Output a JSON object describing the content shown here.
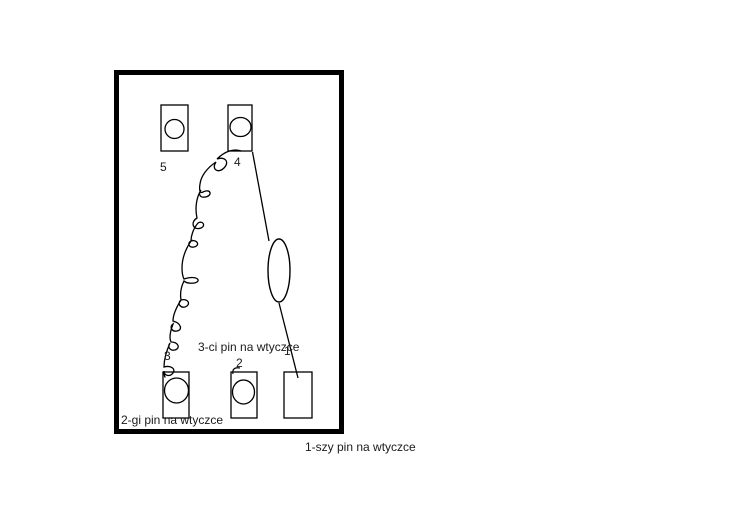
{
  "page": {
    "background_color": "#ffffff",
    "ink_color": "#000000",
    "text_color": "#1a1a1a"
  },
  "diagram": {
    "pin_labels": {
      "pin1": "1",
      "pin2": "2",
      "pin3": "3",
      "pin4": "4",
      "pin5": "5"
    },
    "captions": {
      "third_pin": "3-ci pin na wtyczce",
      "second_pin": "2-gi pin na wtyczce",
      "first_pin": "1-szy pin na wtyczce"
    }
  }
}
